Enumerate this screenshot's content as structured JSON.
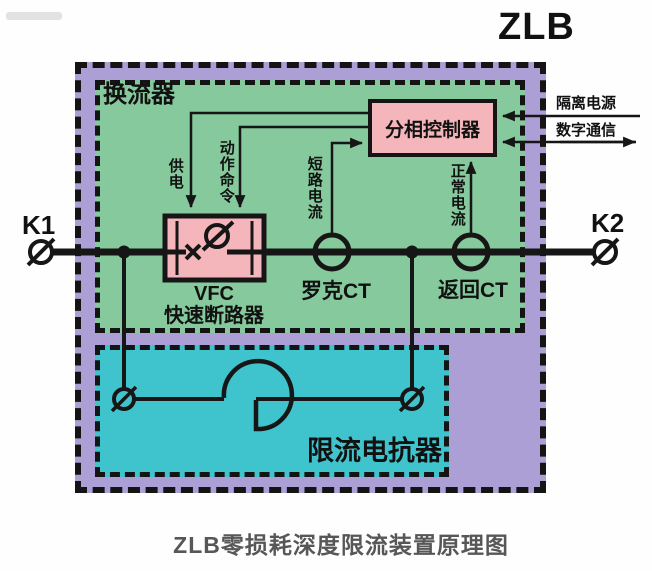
{
  "title": "ZLB",
  "caption": "ZLB零损耗深度限流装置原理图",
  "terminals": {
    "left": "K1",
    "right": "K2"
  },
  "converter": {
    "label": "换流器"
  },
  "controller": {
    "label": "分相控制器"
  },
  "breaker": {
    "model": "VFC",
    "name": "快速断路器"
  },
  "sensors": {
    "rogowski_ct": "罗克CT",
    "return_ct": "返回CT"
  },
  "reactor": {
    "label": "限流电抗器"
  },
  "signals": {
    "supply": "供电",
    "trip_command": "动作命令",
    "short_circuit_current": "短路电流",
    "normal_current": "正常电流",
    "isolated_power": "隔离电源",
    "digital_comm": "数字通信"
  },
  "colors": {
    "outer": "#ab9fd6",
    "converter": "#85c99c",
    "reactor_box": "#3fc3cd",
    "component": "#f4b6ba",
    "wire": "#161616",
    "caption": "#575757"
  }
}
